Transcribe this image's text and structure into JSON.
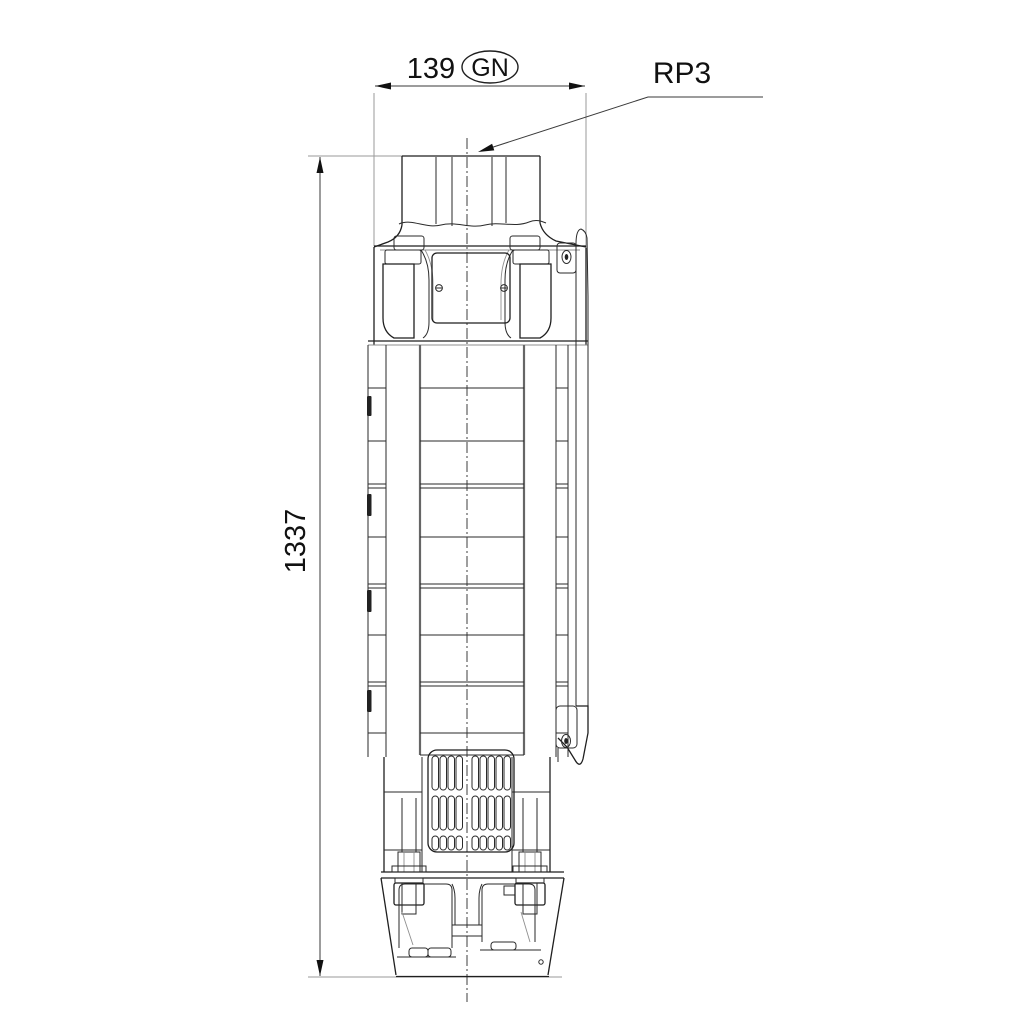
{
  "drawing": {
    "type": "technical-dimension-drawing",
    "subject": "submersible-borehole-pump-outline",
    "annotations": {
      "width_dim": "139",
      "width_tag": "GN",
      "height_dim": "1337",
      "port_label": "RP3"
    },
    "colors": {
      "line": "#1f1f1f",
      "background": "#ffffff"
    }
  }
}
